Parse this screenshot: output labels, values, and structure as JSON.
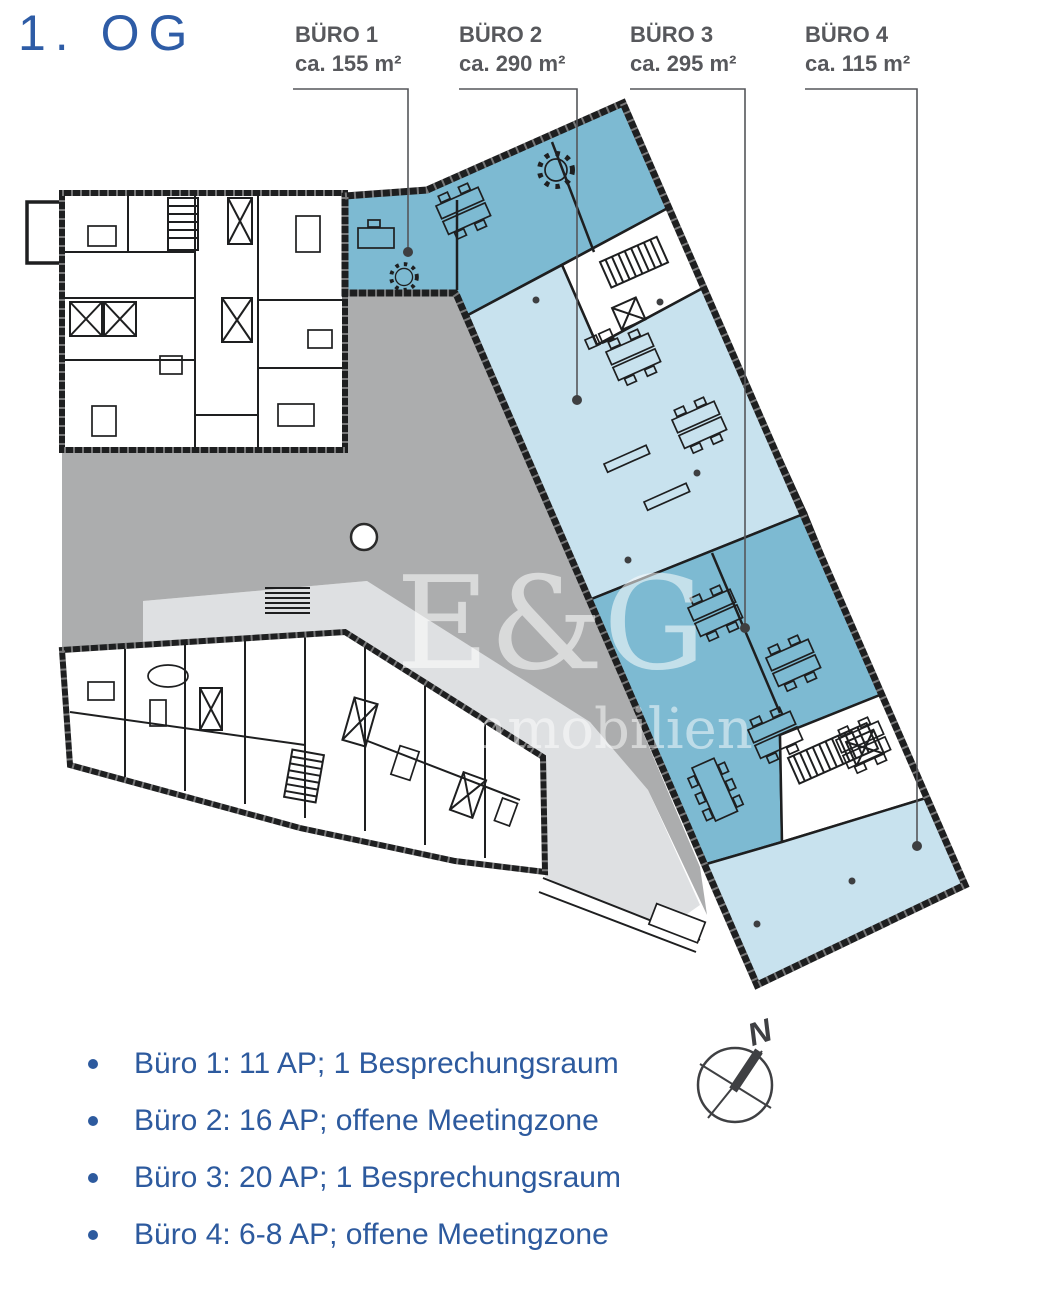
{
  "title": "1. OG",
  "areas": [
    {
      "name": "BÜRO 1",
      "size": "ca. 155 m²"
    },
    {
      "name": "BÜRO 2",
      "size": "ca. 290 m²"
    },
    {
      "name": "BÜRO 3",
      "size": "ca. 295 m²"
    },
    {
      "name": "BÜRO 4",
      "size": "ca. 115 m²"
    }
  ],
  "legend": [
    "Büro 1: 11 AP; 1 Besprechungsraum",
    "Büro 2: 16 AP; offene Meetingzone",
    "Büro 3: 20 AP; 1 Besprechungsraum",
    "Büro 4: 6-8 AP; offene Meetingzone"
  ],
  "watermark": {
    "line1": "E&G",
    "line2": "Immobilien"
  },
  "compass": {
    "label": "N"
  },
  "colors": {
    "accent_blue": "#2E5CA6",
    "text_blue": "#2D5A9E",
    "label_gray": "#57585C",
    "wall": "#1E1F20",
    "office_medium": "#7DBAD2",
    "office_light": "#C8E2EE",
    "courtyard": "#ACADAE",
    "terrace": "#DEE0E2",
    "leader": "#55565A",
    "dot": "#3E3F41"
  }
}
